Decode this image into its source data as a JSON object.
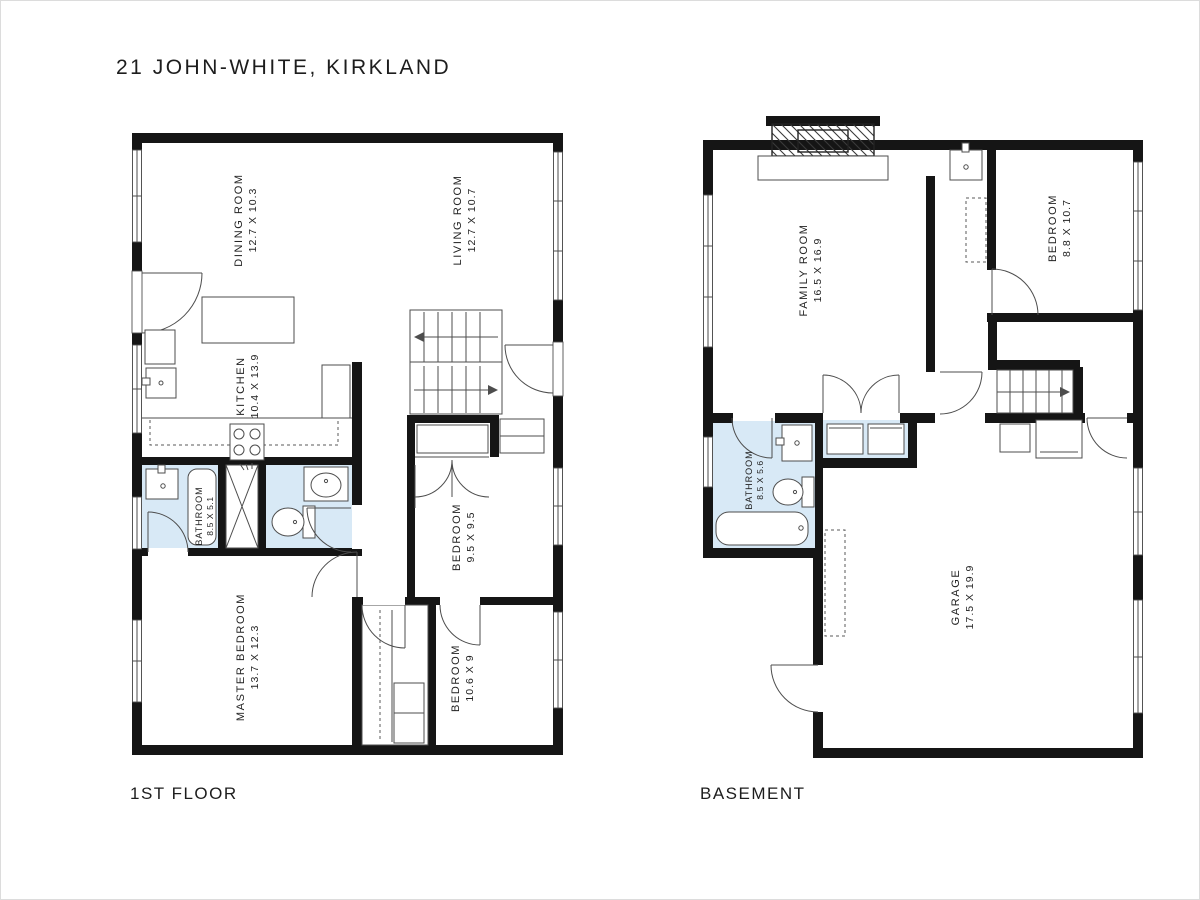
{
  "title": "21 JOHN-WHITE, KIRKLAND",
  "floor1": {
    "label": "1ST FLOOR",
    "rooms": {
      "dining": {
        "name": "DINING ROOM",
        "dims": "12.7 X 10.3"
      },
      "living": {
        "name": "LIVING ROOM",
        "dims": "12.7 X 10.7"
      },
      "kitchen": {
        "name": "KITCHEN",
        "dims": "10.4 X 13.9"
      },
      "bathroom": {
        "name": "BATHROOM",
        "dims": "8.5 X 5.1"
      },
      "bedroom_mid": {
        "name": "BEDROOM",
        "dims": "9.5 X 9.5"
      },
      "master": {
        "name": "MASTER BEDROOM",
        "dims": "13.7 X 12.3"
      },
      "bedroom_low": {
        "name": "BEDROOM",
        "dims": "10.6 X 9"
      }
    }
  },
  "basement": {
    "label": "BASEMENT",
    "rooms": {
      "family": {
        "name": "FAMILY ROOM",
        "dims": "16.5 X 16.9"
      },
      "bedroom": {
        "name": "BEDROOM",
        "dims": "8.8 X 10.7"
      },
      "bathroom": {
        "name": "BATHROOM",
        "dims": "8.5 X 5.6"
      },
      "garage": {
        "name": "GARAGE",
        "dims": "17.5 X 19.9"
      }
    }
  },
  "colors": {
    "wall": "#151515",
    "fixture_fill": "#d8e9f6",
    "line": "#4d4d4d"
  }
}
